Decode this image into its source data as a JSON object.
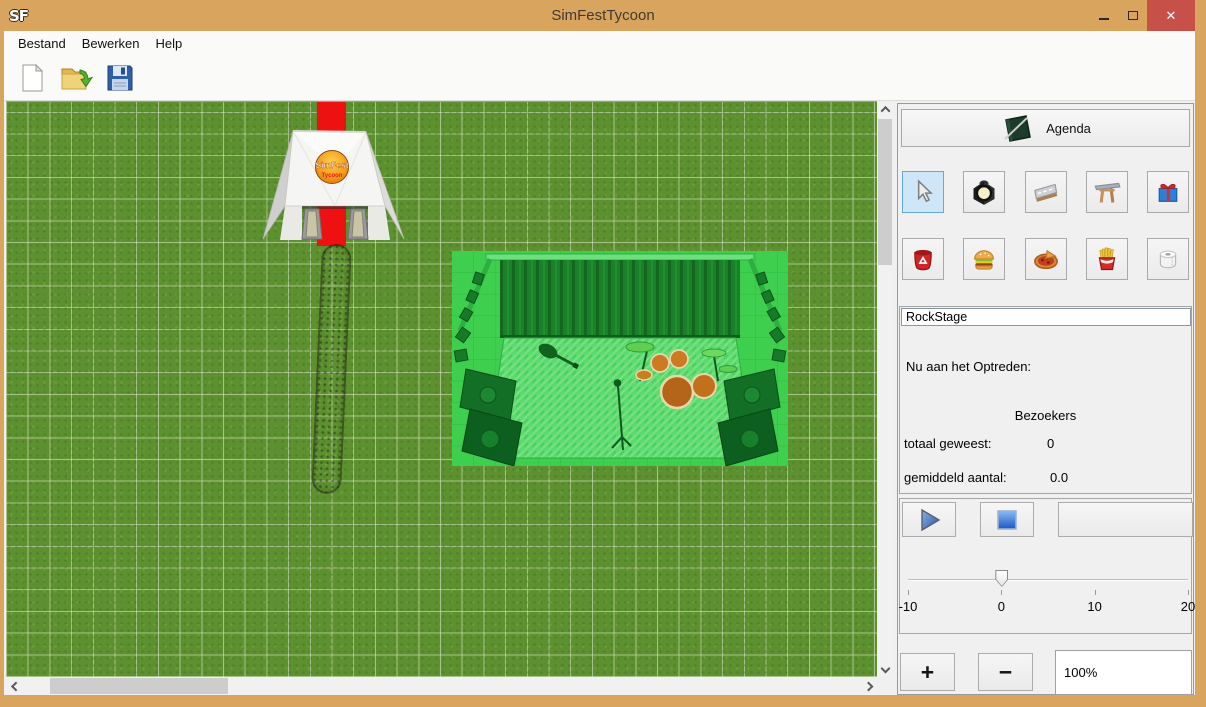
{
  "window": {
    "app_initials": "SF",
    "title": "SimFestTycoon",
    "close_glyph": "✕"
  },
  "menu": {
    "items": [
      {
        "label": "Bestand"
      },
      {
        "label": "Bewerken"
      },
      {
        "label": "Help"
      }
    ]
  },
  "toolbar": {
    "buttons": [
      {
        "name": "new-file"
      },
      {
        "name": "open-file"
      },
      {
        "name": "save-file"
      }
    ]
  },
  "canvas": {
    "objects": {
      "tent": {
        "name": "entrance-tent",
        "logo_line1": "SimFest",
        "logo_line2": "Tycoon"
      },
      "carpet": {
        "name": "red-carpet",
        "color": "#ee1111"
      },
      "path": {
        "name": "dirt-path"
      },
      "stage": {
        "name": "rock-stage",
        "highlight": "green-selection"
      }
    }
  },
  "panel": {
    "agenda": {
      "label": "Agenda"
    },
    "tools": [
      {
        "name": "select-tool",
        "selected": true
      },
      {
        "name": "spotlight-tool",
        "selected": false
      },
      {
        "name": "road-tool",
        "selected": false
      },
      {
        "name": "entrance-gate-tool",
        "selected": false
      },
      {
        "name": "gift-tool",
        "selected": false
      },
      {
        "name": "trash-can-tool",
        "selected": false
      },
      {
        "name": "burger-stand-tool",
        "selected": false
      },
      {
        "name": "pizza-stand-tool",
        "selected": false
      },
      {
        "name": "fries-stand-tool",
        "selected": false
      },
      {
        "name": "toilet-tool",
        "selected": false
      }
    ],
    "stage_info": {
      "name_value": "RockStage",
      "now_label": "Nu aan het Optreden:",
      "visitors_header": "Bezoekers",
      "total_label": "totaal geweest:",
      "total_value": "0",
      "avg_label": "gemiddeld aantal:",
      "avg_value": "0.0"
    },
    "playback": {
      "extra_label": ""
    },
    "slider": {
      "value": 0,
      "min": -10,
      "max": 20,
      "tick_labels": [
        "-10",
        "0",
        "10",
        "20"
      ]
    },
    "zoom": {
      "plus_label": "+",
      "minus_label": "−",
      "level_value": "100%"
    }
  },
  "colors": {
    "titlebar": "#d9a45e",
    "close_button": "#c75148",
    "grass": "#5d9130",
    "carpet_red": "#ee1111",
    "selection_green": "#3ecf4e",
    "selected_tool": "#cfe6f9"
  }
}
